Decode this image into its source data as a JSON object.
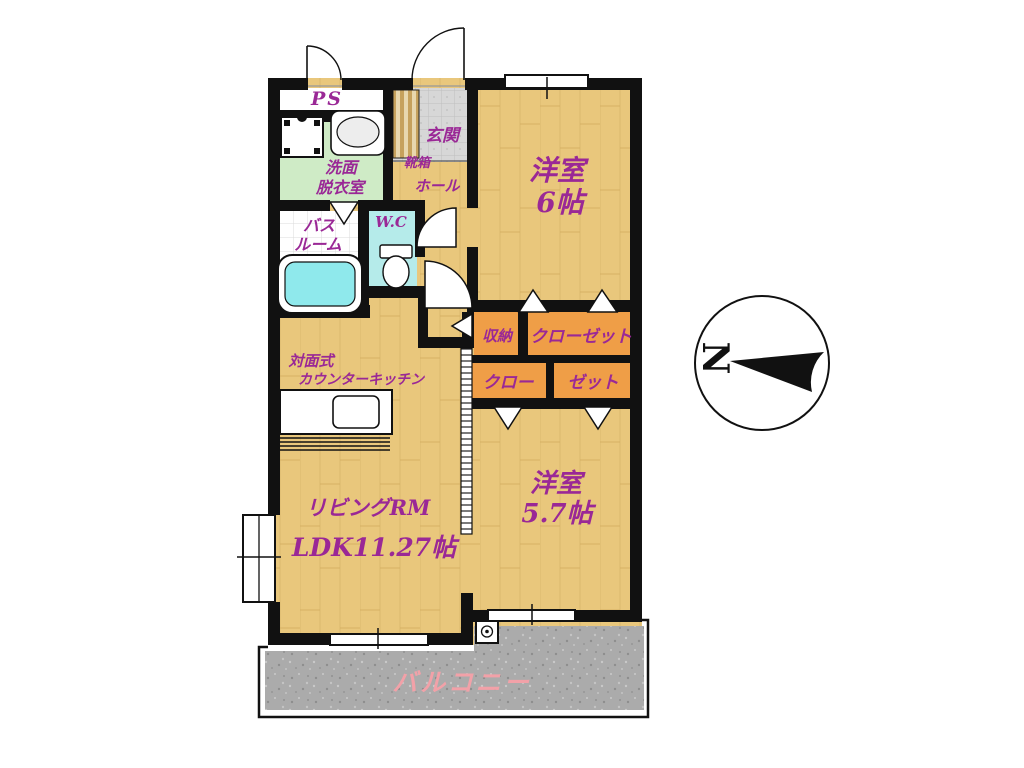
{
  "floorplan": {
    "labels": {
      "ps": "PS",
      "entrance": "玄関",
      "shoe_box": "靴箱",
      "hall": "ホール",
      "washroom_l1": "洗面",
      "washroom_l2": "脱衣室",
      "bathroom_l1": "バス",
      "bathroom_l2": "ルーム",
      "wc": "W.C",
      "room6_l1": "洋室",
      "room6_l2": "6帖",
      "storage": "収納",
      "closet_upper": "クローゼット",
      "closet_lower_left": "クロー",
      "closet_lower_right": "ゼット",
      "kitchen_l1": "対面式",
      "kitchen_l2": "カウンターキッチン",
      "living_l1": "リビングRM",
      "living_l2": "LDK11.27帖",
      "room57_l1": "洋室",
      "room57_l2": "5.7帖",
      "balcony": "バルコニー"
    },
    "compass": {
      "north": "N"
    },
    "colors": {
      "wood_floor": "#E9C77C",
      "wood_grain": "#DCB96E",
      "closet_orange": "#EF9E47",
      "washroom_green": "#CFEBC6",
      "wc_cyan": "#B5EBEA",
      "bathtub_cyan": "#8FE9EC",
      "entrance_tile": "#D7D7D7",
      "balcony_gray": "#ABABAB",
      "label_purple": "#9A2896",
      "balcony_label_pink": "#F2A1A8",
      "wall_black": "#111111"
    }
  }
}
